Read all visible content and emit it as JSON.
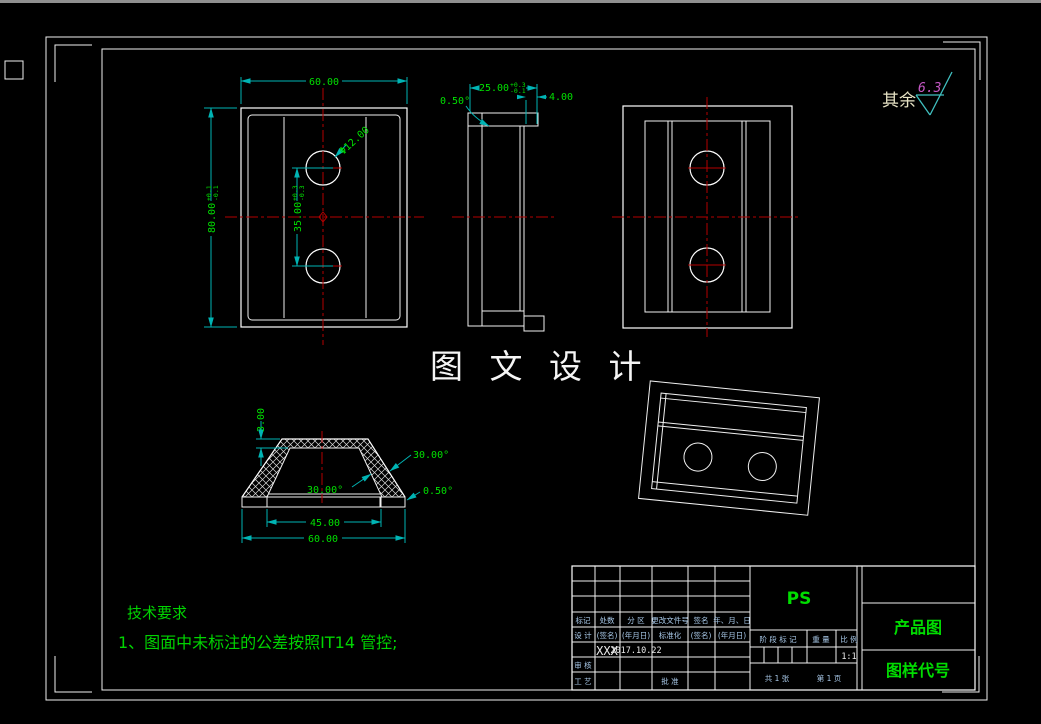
{
  "sheet": {
    "watermark": "图 文 设 计",
    "surface_note_label": "其余",
    "surface_roughness": "6.3",
    "tech_title": "技术要求",
    "tech_item": "1、图面中未标注的公差按照IT14 管控;"
  },
  "front_view": {
    "width": "60.00",
    "height": "80.00",
    "height_tol_up": "+0.1",
    "height_tol_dn": "-0.1",
    "hole_dia": "Φ12.00",
    "hole_spacing": "35.00",
    "spacing_tol_up": "+0.3",
    "spacing_tol_dn": "-0.3"
  },
  "side_view": {
    "depth": "25.00",
    "depth_tol_up": "+0.3",
    "depth_tol_dn": "-0.1",
    "step": "4.00",
    "taper": "0.50°"
  },
  "section_view": {
    "top_thickness": "3.00",
    "outer_angle": "30.00°",
    "inner_angle": "30.00°",
    "base_taper": "0.50°",
    "inner_width": "45.00",
    "outer_width": "60.00"
  },
  "title_block": {
    "rev_headers": [
      "标记",
      "处数",
      "分 区",
      "更改文件号",
      "签名",
      "年、月、日"
    ],
    "sign_headers": [
      "设 计",
      "(签名)",
      "(年月日)",
      "标准化",
      "(签名)",
      "(年月日)"
    ],
    "designer_name": "XXX",
    "design_date": "2017.10.22",
    "row_shenhe": "审 核",
    "row_gongyi": "工 艺",
    "row_pizhun": "批 准",
    "stage_label": "阶 段 标 记",
    "weight_label": "重 量",
    "scale_label": "比 例",
    "scale_value": "1:1",
    "sheet_count": "共 1 张",
    "page_count": "第 1 页",
    "company": "PS",
    "drawing_title": "产品图",
    "drawing_code": "图样代号"
  }
}
